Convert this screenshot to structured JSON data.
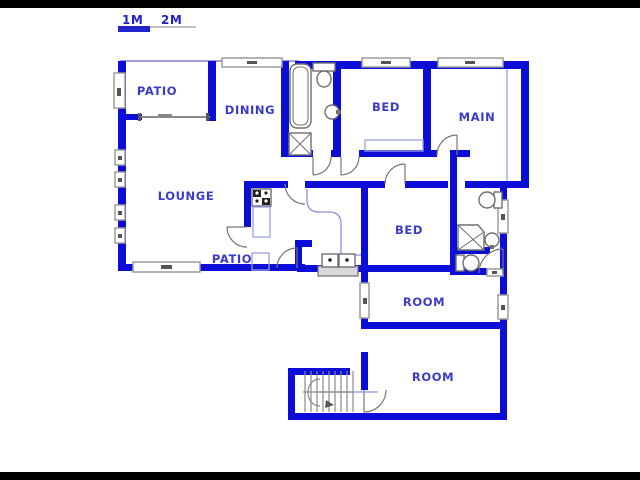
{
  "title": "house floor plan",
  "colors": {
    "wall": "#0d0dd8",
    "label": "#3a3acc",
    "scale_blue": "#2222cc",
    "scale_gray": "#c0c0c0"
  },
  "scale_bar": {
    "label_1m": "1M",
    "label_2m": "2M"
  },
  "rooms": [
    {
      "id": "patio-top",
      "label": "PATIO"
    },
    {
      "id": "dining",
      "label": "DINING"
    },
    {
      "id": "bed-top",
      "label": "BED"
    },
    {
      "id": "main",
      "label": "MAIN"
    },
    {
      "id": "lounge",
      "label": "LOUNGE"
    },
    {
      "id": "patio-bottom",
      "label": "PATIO"
    },
    {
      "id": "bed-middle",
      "label": "BED"
    },
    {
      "id": "room-upper",
      "label": "ROOM"
    },
    {
      "id": "room-lower",
      "label": "ROOM"
    }
  ],
  "fixtures": [
    "bathtub",
    "toilet",
    "wash-basin",
    "shower",
    "stove",
    "kitchen-sink",
    "corner-shower",
    "toilet",
    "wash-basin",
    "toilet",
    "staircase",
    "wardrobe",
    "counter"
  ]
}
